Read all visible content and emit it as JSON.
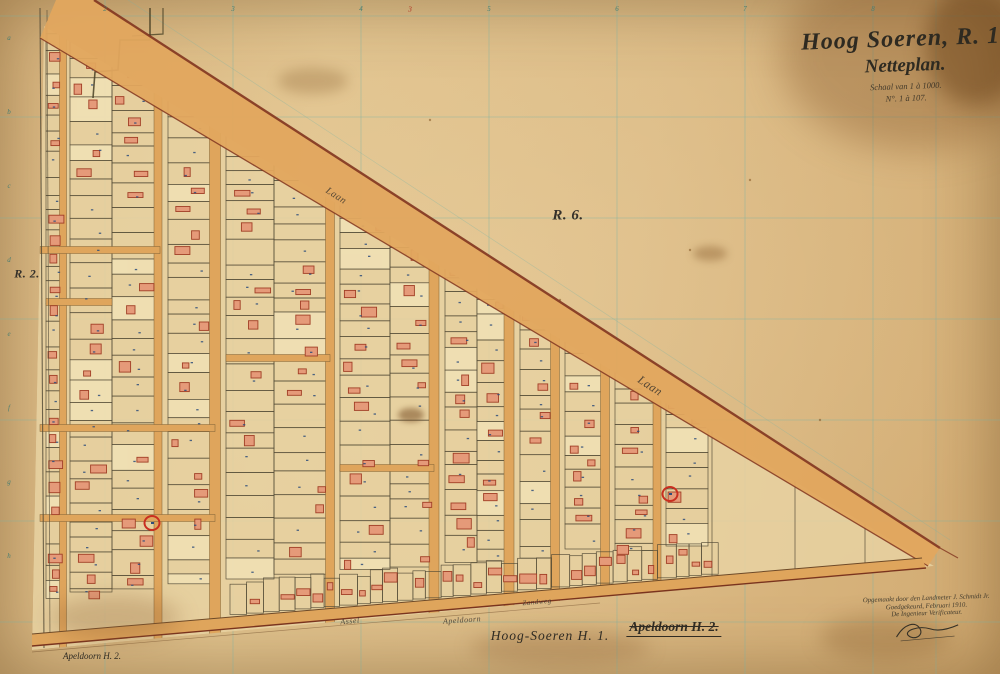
{
  "sheet": {
    "title": "Hoog Soeren, R. 1.",
    "subtitle": "Netteplan.",
    "scale_note": "Schaal van 1 à 1000.",
    "sheet_number": "N°. 1 à 107.",
    "bottom_sheet_label": "Hoog-Soeren H. 1.",
    "bottom_adjacent_label": "Apeldoorn H. 2.",
    "bottom_left_corner_label": "Apeldoorn H. 2.",
    "top_edge_red_mark": "3"
  },
  "region_labels": [
    {
      "text": "R. 6.",
      "x": 568,
      "y": 216,
      "size": 15
    },
    {
      "text": "R. 2.",
      "x": 27,
      "y": 274,
      "size": 12
    }
  ],
  "road_labels": [
    {
      "text": "Laan",
      "x": 336,
      "y": 196,
      "angle": 33,
      "size": 10
    },
    {
      "text": "Laan",
      "x": 650,
      "y": 386,
      "angle": 33,
      "size": 12
    },
    {
      "text": "Assel",
      "x": 350,
      "y": 621,
      "angle": -5,
      "size": 8
    },
    {
      "text": "Apeldoorn",
      "x": 462,
      "y": 620,
      "angle": -4,
      "size": 8
    },
    {
      "text": "Zandweg",
      "x": 537,
      "y": 602,
      "angle": -5,
      "size": 7
    }
  ],
  "edge_markers": {
    "top_numbers": [
      {
        "t": "2",
        "x": 105
      },
      {
        "t": "3",
        "x": 233
      },
      {
        "t": "4",
        "x": 361
      },
      {
        "t": "5",
        "x": 489
      },
      {
        "t": "6",
        "x": 617
      },
      {
        "t": "7",
        "x": 745
      },
      {
        "t": "8",
        "x": 873
      }
    ],
    "left_letters": [
      {
        "t": "a",
        "y": 38
      },
      {
        "t": "b",
        "y": 112
      },
      {
        "t": "c",
        "y": 186
      },
      {
        "t": "d",
        "y": 260
      },
      {
        "t": "e",
        "y": 334
      },
      {
        "t": "f",
        "y": 408
      },
      {
        "t": "g",
        "y": 482
      },
      {
        "t": "h",
        "y": 556
      }
    ]
  },
  "survey_markers": [
    {
      "x": 152,
      "y": 523
    },
    {
      "x": 670,
      "y": 494
    }
  ],
  "signature_block": {
    "lines": [
      "Opgemaakt door den Landmeter J. Schmidt Jr.",
      "Goedgekeurd, Februari 1910.",
      "De Ingenieur Verificateur."
    ]
  },
  "colors": {
    "paper": "#dcba85",
    "parcel_fill": "#e7d2a2",
    "parcel_line": "#4f4733",
    "road": "#dfa55c",
    "band": "#e2a75e",
    "band_edge": "#823620",
    "building": "#e59a79",
    "building_edge": "#a13f26",
    "grid": "#79b2a4",
    "ink": "#332d22",
    "marker_red": "#c92f20",
    "number_blue": "#2e4d7b"
  }
}
